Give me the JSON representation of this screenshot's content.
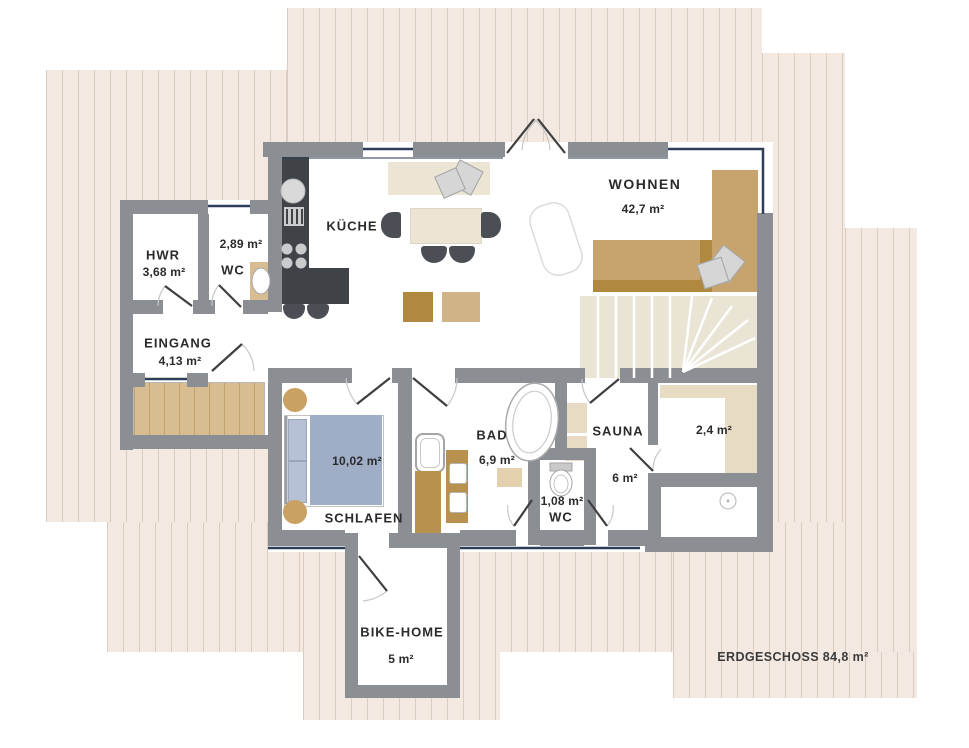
{
  "plan": {
    "floor_label": "ERDGESCHOSS 84,8 m²",
    "rooms": {
      "wohnen": {
        "name": "WOHNEN",
        "area": "42,7 m²"
      },
      "kueche": {
        "name": "KÜCHE"
      },
      "hwr": {
        "name": "HWR",
        "area": "3,68 m²"
      },
      "wc": {
        "name": "WC",
        "area": "2,89 m²"
      },
      "eingang": {
        "name": "EINGANG",
        "area": "4,13 m²"
      },
      "schlafen": {
        "name": "SCHLAFEN",
        "area": "10,02 m²"
      },
      "bad": {
        "name": "BAD",
        "area": "6,9 m²"
      },
      "wc_klein": {
        "name": "WC",
        "area": "1,08 m²"
      },
      "sauna": {
        "name": "SAUNA",
        "area": "6 m²"
      },
      "abstellraum": {
        "area": "2,4 m²"
      },
      "bikehome": {
        "name": "BIKE-HOME",
        "area": "5 m²"
      }
    },
    "colors": {
      "wall": "#8b8e92",
      "exterior_outline_navy": "#2e3d59",
      "terrace_fill": "#f4e9e1",
      "terrace_stripe": "#d9ccc1",
      "furniture_tan": "#c7a36e",
      "furniture_dark_tan": "#b0883f",
      "kitchen_counter": "#3f4348",
      "bed_blue": "#9fadc6",
      "bench_beige": "#e7dbc4",
      "cream": "#ece5d3"
    }
  }
}
